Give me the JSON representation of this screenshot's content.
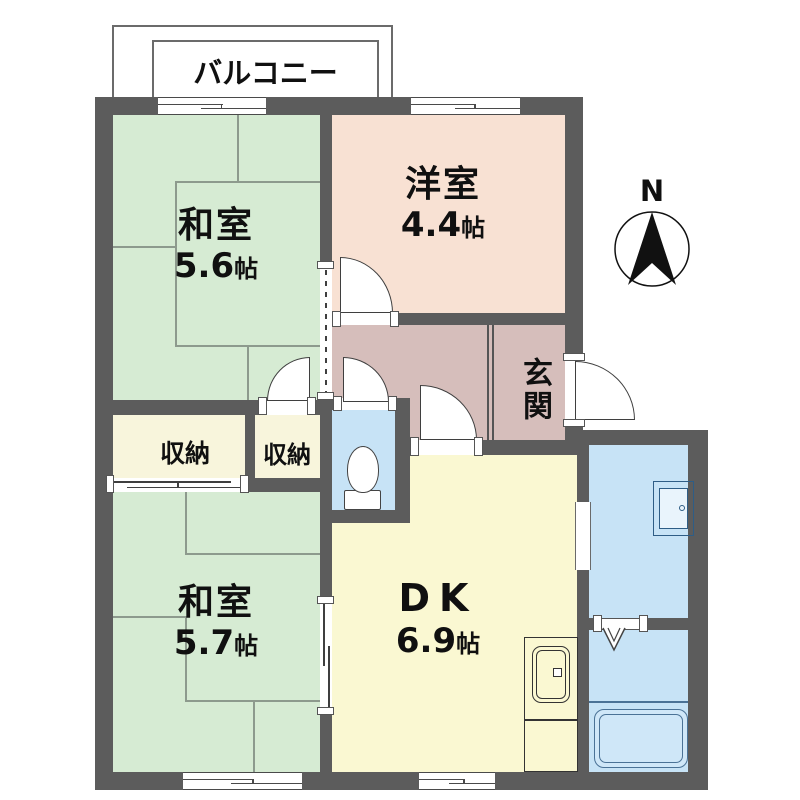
{
  "floorplan": {
    "balcony": {
      "label": "バルコニー"
    },
    "compass": {
      "label": "N"
    },
    "rooms": {
      "washitsu1": {
        "name": "和室",
        "area": "5.6",
        "unit": "帖"
      },
      "yoshitsu": {
        "name": "洋室",
        "area": "4.4",
        "unit": "帖"
      },
      "genkan": {
        "name": "玄関"
      },
      "closet1": {
        "name": "収納"
      },
      "closet2": {
        "name": "収納"
      },
      "washitsu2": {
        "name": "和室",
        "area": "5.7",
        "unit": "帖"
      },
      "dk": {
        "name": "DK",
        "area": "6.9",
        "unit": "帖"
      }
    },
    "colors": {
      "wall": "#5c5c5c",
      "tatami_green": "#d6ebd3",
      "western_peach": "#f8e1d3",
      "hall_mauve": "#d6bebb",
      "closet_cream": "#f8f5dc",
      "dk_yellow": "#faf8d2",
      "wet_blue": "#c7e3f6",
      "fixture_blue": "#2e5d86"
    }
  }
}
